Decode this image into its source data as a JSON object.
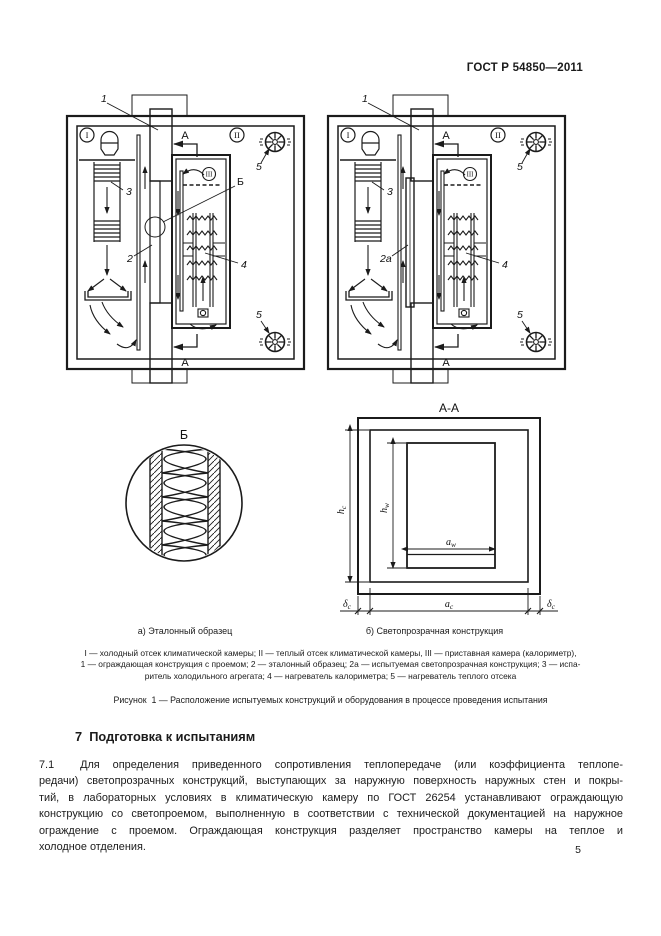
{
  "page": {
    "header": "ГОСТ Р 54850—2011",
    "page_number": "5"
  },
  "figure": {
    "diagram_a": {
      "label_1": "1",
      "label_2": "2",
      "label_3": "3",
      "label_4": "4",
      "label_5_top": "5",
      "label_5_bottom": "5",
      "label_b": "Б",
      "label_a_top": "А",
      "label_a_bottom": "А",
      "roman_i": "I",
      "roman_ii": "II",
      "roman_iii": "III"
    },
    "diagram_b": {
      "label_1": "1",
      "label_2a": "2а",
      "label_3": "3",
      "label_4": "4",
      "label_5_top": "5",
      "label_5_bottom": "5",
      "label_a_top": "А",
      "label_a_bottom": "А",
      "roman_i": "I",
      "roman_ii": "II",
      "roman_iii": "III"
    },
    "detail_b": {
      "title": "Б",
      "caption": "а) Эталонный образец"
    },
    "section_aa": {
      "title": "А-А",
      "caption": "б) Светопрозрачная конструкция",
      "dim_hc": {
        "main": "h",
        "sub": "c"
      },
      "dim_hw": {
        "main": "h",
        "sub": "w"
      },
      "dim_aw": {
        "main": "a",
        "sub": "w"
      },
      "dim_ac": {
        "main": "a",
        "sub": "c"
      },
      "dim_dc_left": {
        "main": "δ",
        "sub": "c"
      },
      "dim_dc_right": {
        "main": "δ",
        "sub": "c"
      }
    },
    "legend_lines": [
      "I — холодный отсек климатической камеры; II — теплый отсек климатической камеры, III — приставная камера (калориметр),",
      "1 — ограждающая конструкция с проемом; 2 — эталонный образец; 2а — испытуемая светопрозрачная конструкция; 3 — испа-",
      "ритель холодильного агрегата; 4 — нагреватель калориметра; 5 — нагреватель теплого отсека"
    ],
    "caption": "Рисунок  1 — Расположение испытуемых конструкций и оборудования в процессе проведения испытания"
  },
  "section7": {
    "heading": "7  Подготовка к испытаниям",
    "para_lines": [
      "7.1  Для определения приведенного сопротивления теплопередаче (или коэффициента теплопе-",
      "редачи) светопрозрачных конструкций, выступающих за наружную поверхность наружных стен и покры-",
      "тий, в лабораторных условиях в климатическую камеру по ГОСТ 26254 устанавливают ограждающую",
      "конструкцию со светопроемом, выполненную в соответствии с технической документацией на наружное",
      "ограждение с проемом. Ограждающая конструкция разделяет пространство камеры на теплое и",
      "холодное отделения."
    ]
  }
}
